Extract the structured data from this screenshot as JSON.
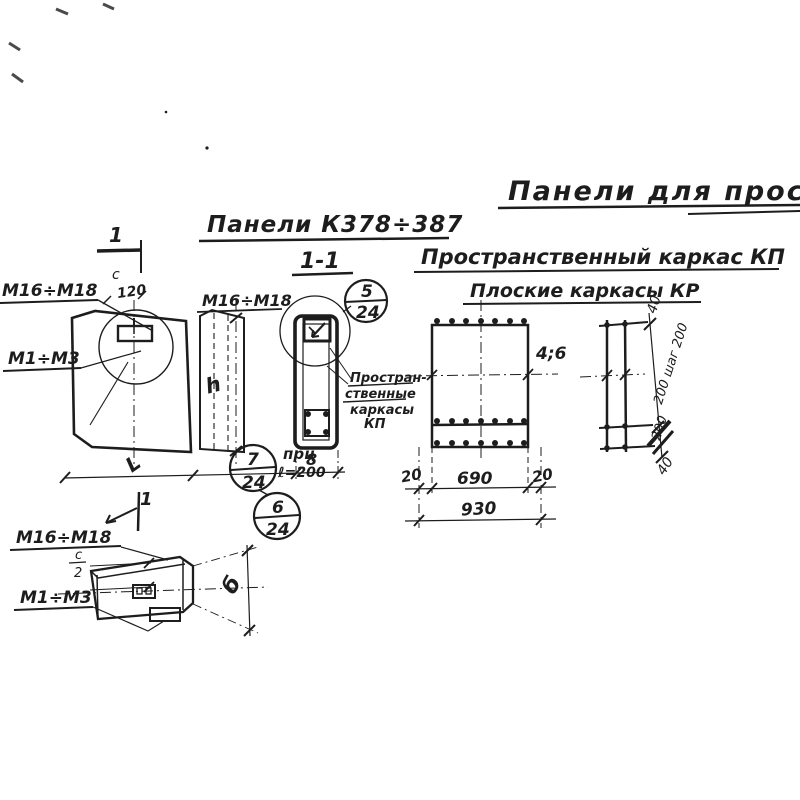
{
  "ink": "#1d1d1d",
  "paper": "#ffffff",
  "titles": {
    "main": "Панели для прост",
    "panels_range": "Панели К378÷387",
    "section": "1-1",
    "kp": "Пространственный каркас КП",
    "kr": "Плоские каркасы КР"
  },
  "front": {
    "cut_top": "1",
    "cut_bottom": "1",
    "dim_c": "с",
    "dim_120": "120",
    "label_m16": "М16÷М18",
    "label_m1": "М1÷М3",
    "dim_h": "h",
    "dim_L": "L"
  },
  "section": {
    "label_m16": "М16÷М18",
    "callout5_num": "5",
    "callout5_den": "24",
    "callout7_num": "7",
    "callout7_den": "24",
    "callout6_num": "6",
    "callout6_den": "24",
    "note_line1": "прц",
    "note_line2": "ℓ=200",
    "dim_width": "8",
    "annotation": [
      "Простран-",
      "ственные",
      "каркасы",
      "КП"
    ]
  },
  "kp": {
    "label_pos": "4;6",
    "dim_20_left": "20",
    "dim_690": "690",
    "dim_20_right": "20",
    "dim_930": "930"
  },
  "kr": {
    "dim_40_top": "40",
    "dim_mid": "200 шаг 200",
    "dim_200": "200",
    "dim_40_bottom": "40"
  },
  "plan": {
    "cut": "1",
    "label_m16": "М16÷М18",
    "label_m1": "М1÷М3",
    "dim_c_num": "с",
    "dim_c_den": "2",
    "dim_b": "б"
  }
}
